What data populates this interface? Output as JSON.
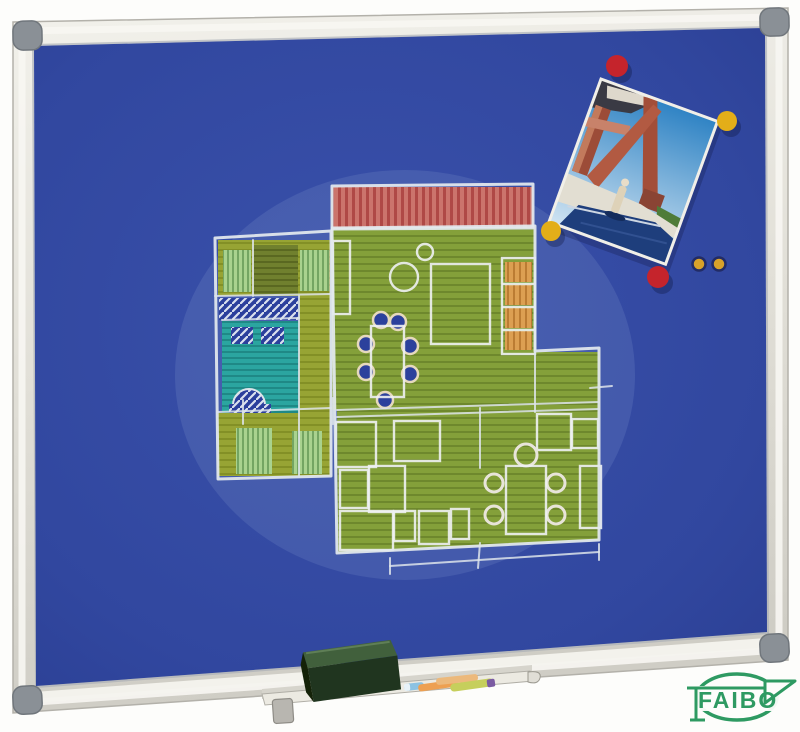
{
  "scene": {
    "description": "Blue felt notice board with aluminium frame; chalk floor-plan drawing; photo pinned with round magnets; pen tray holding a dark green eraser and chalk sticks; FAIBO brand logo at bottom right"
  },
  "logo": {
    "text": "FAIBO",
    "color": "#2e9a62"
  },
  "board": {
    "felt_color": "#31479f",
    "frame_light": "#efeee8",
    "frame_mid": "#d6d4cc",
    "frame_shadow": "#b3b1aa",
    "corner_cap_color": "#8a9096"
  },
  "magnets": {
    "large_red_color": "#c5242c",
    "large_yellow_color": "#e3ae19",
    "small_yellow_color": "#d8a22a",
    "large_count": 4,
    "small_count": 2
  },
  "drawing": {
    "type": "chalk floor plan",
    "terrace_red": "#cb746c",
    "floor_green": "#84a03a",
    "wing_olive": "#97a434",
    "door_light_green": "#a9d28e",
    "bath_teal": "#2ba5a0",
    "furniture_orange": "#dc9f52",
    "hatch_blue": "#2b3f9c",
    "chalk_white": "#e3e9ee"
  },
  "photo": {
    "subject": "terracotta building with swimming pool and figure",
    "sky_color": "#2f83c4",
    "building_color": "#a34e38",
    "pool_color": "#1e3e7c"
  },
  "tray": {
    "eraser_color": "#20351f",
    "chalk_blue": "#8cc2e2",
    "chalk_orange": "#eda052",
    "chalk_tan": "#ecb97c",
    "chalk_green": "#c6cf5c"
  }
}
